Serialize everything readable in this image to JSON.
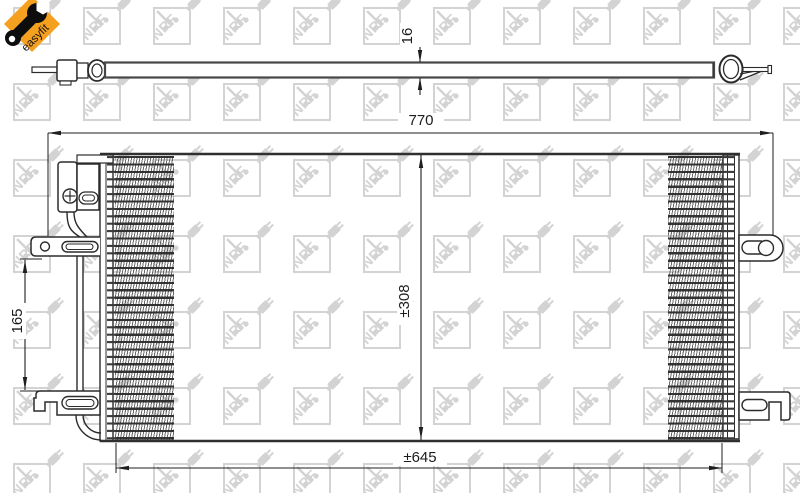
{
  "logo": {
    "label": "easyfit",
    "orange": "#f5a01f",
    "icon": "wrench-icon"
  },
  "watermark": {
    "text": "NRF",
    "color": "#d3d3d3"
  },
  "drawing": {
    "line_color": "#2b2b2b",
    "views": {
      "top_view": "condenser-side-profile",
      "front_view": "condenser-front"
    }
  },
  "dimensions": {
    "thickness": {
      "label": "16"
    },
    "overall_width": {
      "label": "770"
    },
    "core_height": {
      "label": "±308"
    },
    "bracket_spacing": {
      "label": "165"
    },
    "core_width": {
      "label": "±645"
    }
  }
}
